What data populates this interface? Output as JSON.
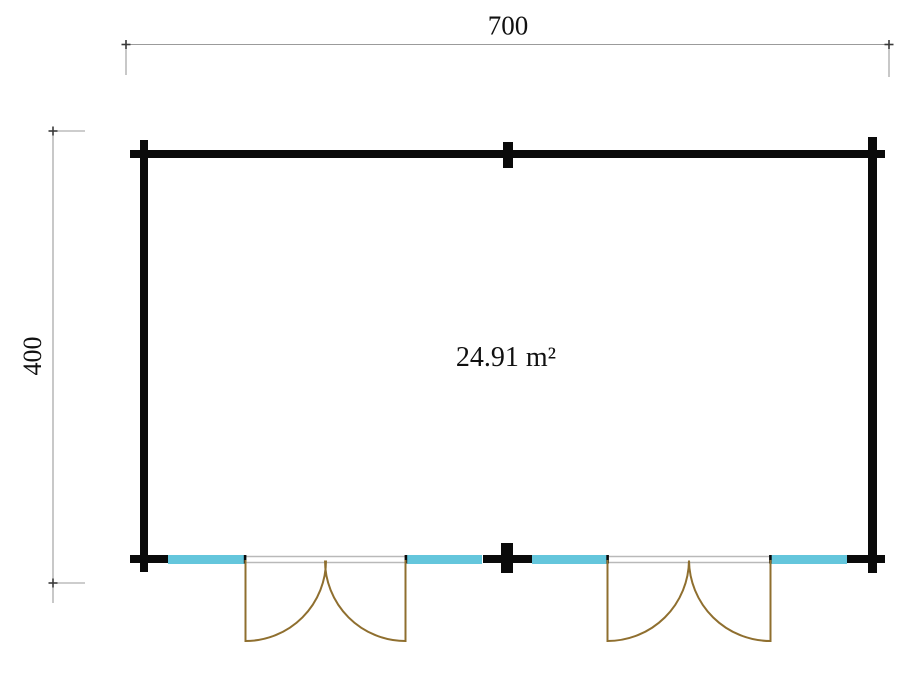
{
  "colors": {
    "background": "#ffffff",
    "wall": "#0a0a0a",
    "window": "#64c6dc",
    "door": "#8f6f2f",
    "door_frame": "#b9b9b9",
    "dimension_line": "#9b9b9b",
    "dimension_tick": "#3a3a3a",
    "label_text": "#111111"
  },
  "dimension_labels": {
    "width": "700",
    "height": "400"
  },
  "area_label": "24.91 m²",
  "plan_features": {
    "window_count": 4,
    "double_door_count": 2
  }
}
